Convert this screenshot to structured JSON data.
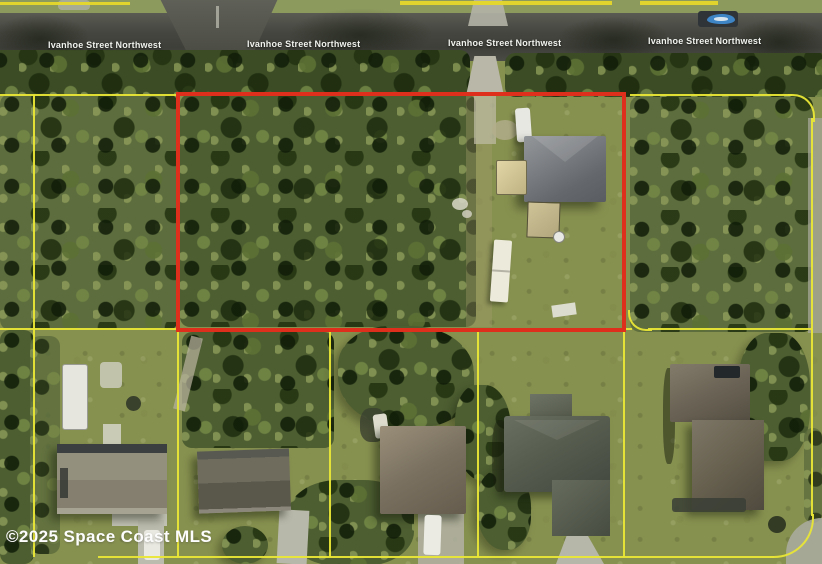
{
  "map": {
    "street_labels": [
      "Ivanhoe Street Northwest",
      "Ivanhoe Street Northwest",
      "Ivanhoe Street Northwest",
      "Ivanhoe Street Northwest"
    ],
    "watermark": "©2025 Space Coast MLS",
    "colors": {
      "subject_outline_red": "#de2e1c",
      "parcel_line_yellow": "#e9e636",
      "road_asphalt": "#4a4b43",
      "lawn_green": "#87914f",
      "tree_canopy_green": "#4d5e31",
      "street_label_text": "#f0f2ee",
      "watermark_text": "#fdfdfd",
      "boat_blue": "#3e85c6"
    }
  }
}
